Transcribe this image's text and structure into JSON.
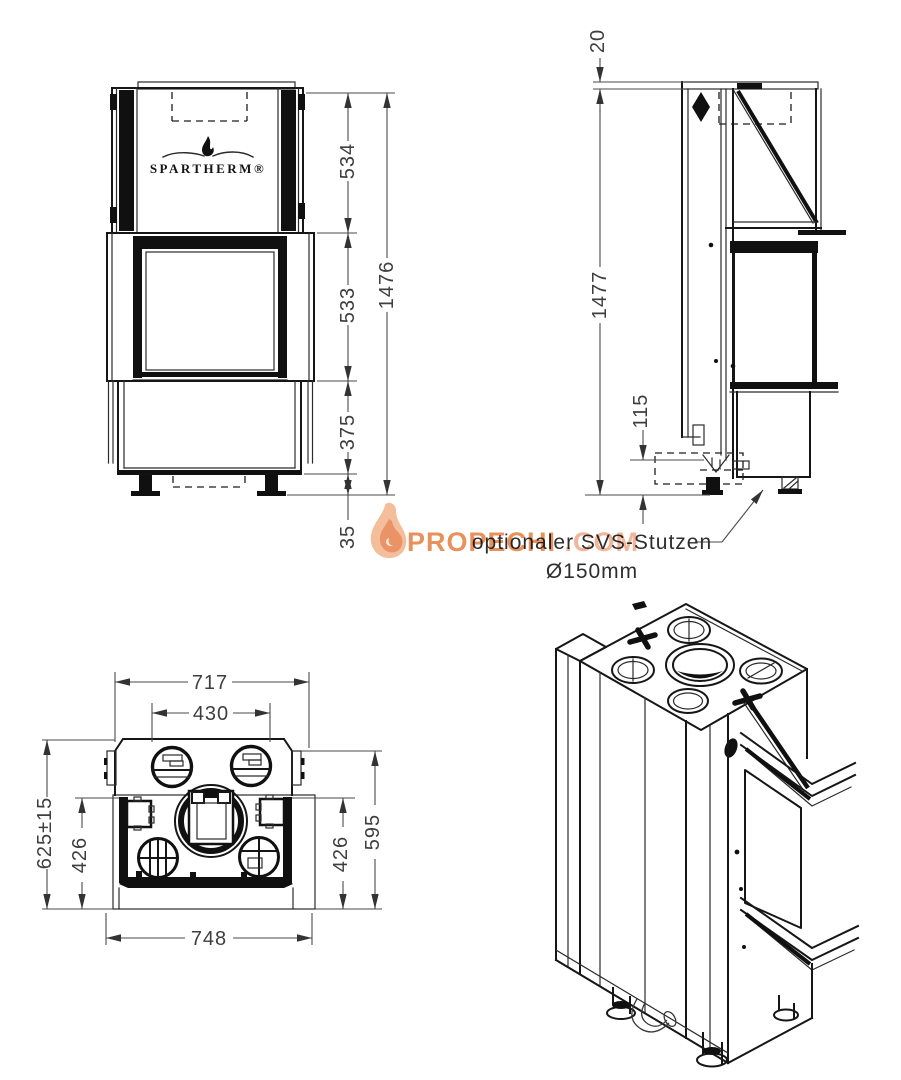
{
  "brand": {
    "logo": "SPARTHERM®"
  },
  "front_view": {
    "dim_upper_section": "534",
    "dim_middle_section": "533",
    "dim_lower_section": "375",
    "dim_feet": "35",
    "dim_total_height": "1476"
  },
  "side_view": {
    "dim_top_plate": "20",
    "dim_total_height": "1477",
    "dim_stub_height": "115",
    "optional_label": "optionaler SVS-Stutzen",
    "optional_diameter": "Ø150mm"
  },
  "top_view": {
    "dim_width_top": "717",
    "dim_width_inner": "430",
    "dim_depth_overall": "625±15",
    "dim_depth_left": "426",
    "dim_depth_right": "426",
    "dim_depth_outer": "595",
    "dim_width_base": "748"
  },
  "watermark": {
    "site_name": "PROPECHI",
    "site_tld": ".COM",
    "color_primary": "#E8894F",
    "color_secondary": "#F2B091"
  }
}
